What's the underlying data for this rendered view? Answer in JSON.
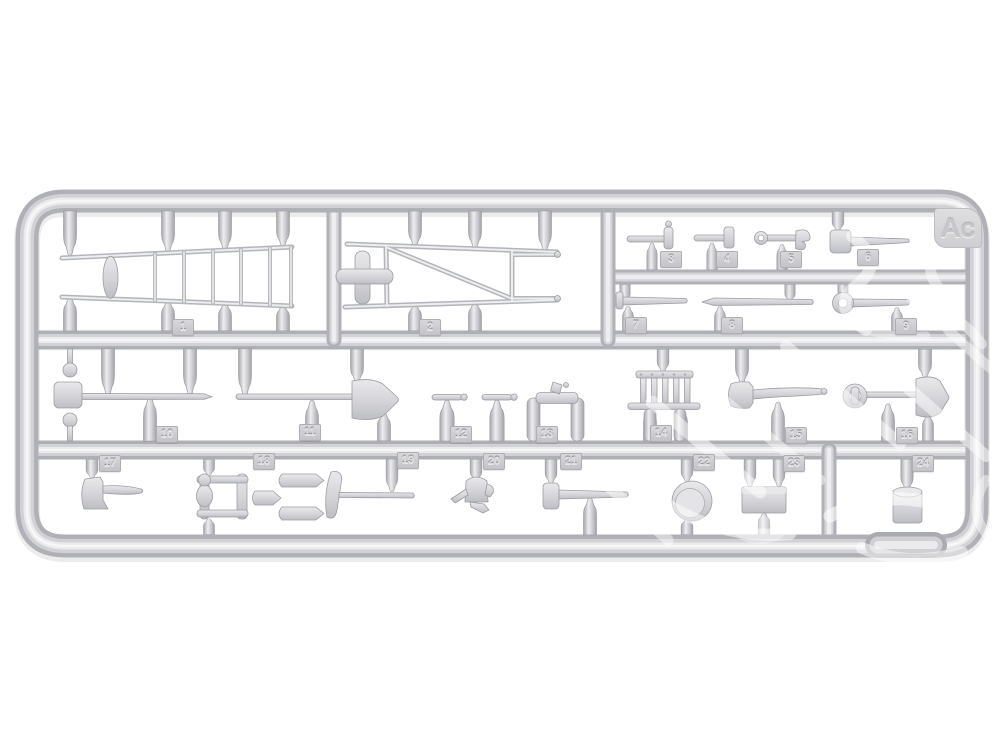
{
  "sprue": {
    "code": "Ac",
    "material": "grey styrene plastic sprue",
    "part_count": 24
  },
  "parts": [
    {
      "number": "1",
      "name": "tapered ladder"
    },
    {
      "number": "2",
      "name": "braced ladder frame"
    },
    {
      "number": "3",
      "name": "small hammer"
    },
    {
      "number": "4",
      "name": "hammer"
    },
    {
      "number": "5",
      "name": "combination wrench"
    },
    {
      "number": "6",
      "name": "sledgehammer"
    },
    {
      "number": "7",
      "name": "punch"
    },
    {
      "number": "8",
      "name": "crowbar"
    },
    {
      "number": "9",
      "name": "ring wrench"
    },
    {
      "number": "10",
      "name": "brush rod"
    },
    {
      "number": "11",
      "name": "long-handled spade"
    },
    {
      "number": "12",
      "name": "t-handle tool"
    },
    {
      "number": "13",
      "name": "wood plane"
    },
    {
      "number": "14",
      "name": "grate"
    },
    {
      "number": "15",
      "name": "felling axe"
    },
    {
      "number": "16",
      "name": "d-handle shovel"
    },
    {
      "number": "17",
      "name": "hatchet"
    },
    {
      "number": "18",
      "name": "folding frame"
    },
    {
      "number": "19",
      "name": "pickaxe"
    },
    {
      "number": "20",
      "name": "oil can"
    },
    {
      "number": "21",
      "name": "hammer"
    },
    {
      "number": "22",
      "name": "round lid"
    },
    {
      "number": "23",
      "name": "box"
    },
    {
      "number": "24",
      "name": "bucket"
    }
  ],
  "colors": {
    "background": "#ffffff",
    "plastic_base": "#d2d2d6",
    "plastic_dark": "#b0b1b6",
    "plastic_light": "#ebebee",
    "highlight": "#f7f7f8",
    "watermark": "#ffffff"
  }
}
